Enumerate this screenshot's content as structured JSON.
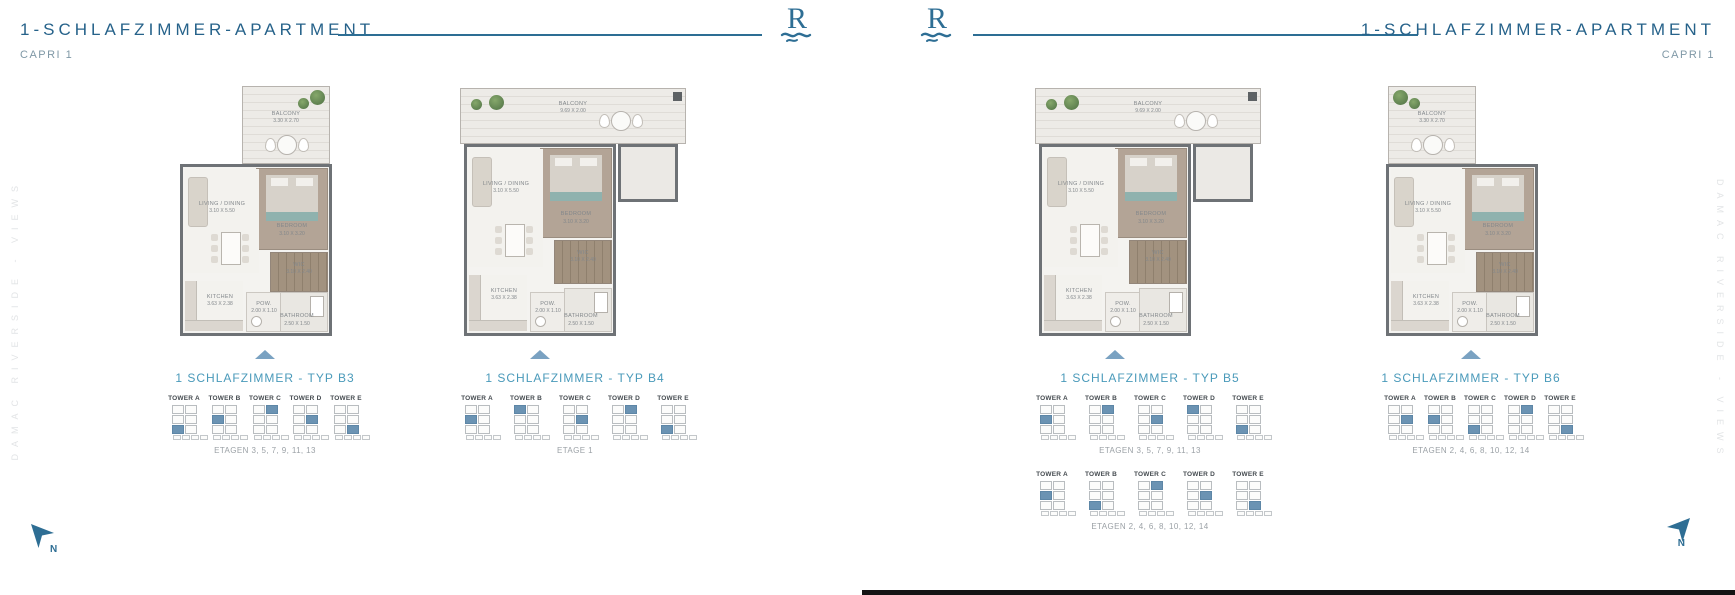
{
  "page": {
    "left": {
      "title": "1-SCHLAFZIMMER-APARTMENT",
      "subtitle": "CAPRI 1"
    },
    "right": {
      "title": "1-SCHLAFZIMMER-APARTMENT",
      "subtitle": "CAPRI 1"
    },
    "side_text": "DAMAC RIVERSIDE - VIEWS",
    "logo_letter": "R",
    "compass_label": "N"
  },
  "colors": {
    "title_blue": "#26628a",
    "accent_teal": "#4a9aba",
    "rule_blue": "#2d6e94",
    "tower_highlight": "#6b93b3",
    "caption_gray": "#9ba1a6"
  },
  "plans": [
    {
      "id": "b3",
      "label": "1 SCHLAFZIMMER - TYP B3",
      "variant": "small",
      "balcony_side": "right",
      "rooms": {
        "balcony": {
          "name": "BALCONY",
          "dims": "3.30 X 2.70"
        },
        "bedroom": {
          "name": "BEDROOM",
          "dims": "3.10 X 3.20"
        },
        "living": {
          "name": "LIVING / DINING",
          "dims": "3.10 X 5.50"
        },
        "wic": {
          "name": "WIC",
          "dims": "3.10 X 2.40"
        },
        "kitchen": {
          "name": "KITCHEN",
          "dims": "3.63 X 2.38"
        },
        "pow": {
          "name": "POW.",
          "dims": "2.00 X 1.10"
        },
        "bath": {
          "name": "BATHROOM",
          "dims": "2.50 X 1.50"
        }
      },
      "tower_rows": [
        {
          "towers": [
            "TOWER A",
            "TOWER B",
            "TOWER C",
            "TOWER D",
            "TOWER E"
          ],
          "highlights": [
            4,
            2,
            1,
            3,
            5
          ],
          "caption": "ETAGEN 3, 5, 7, 9, 11, 13"
        }
      ]
    },
    {
      "id": "b4",
      "label": "1 SCHLAFZIMMER - TYP B4",
      "variant": "large",
      "balcony_side": "right",
      "rooms": {
        "balcony": {
          "name": "BALCONY",
          "dims": "9.69 X 2.00"
        },
        "bedroom": {
          "name": "BEDROOM",
          "dims": "3.10 X 3.20"
        },
        "living": {
          "name": "LIVING / DINING",
          "dims": "3.10 X 5.50"
        },
        "wic": {
          "name": "WIC",
          "dims": "3.10 X 2.40"
        },
        "kitchen": {
          "name": "KITCHEN",
          "dims": "3.63 X 2.38"
        },
        "pow": {
          "name": "POW.",
          "dims": "2.00 X 1.10"
        },
        "bath": {
          "name": "BATHROOM",
          "dims": "2.50 X 1.50"
        }
      },
      "tower_rows": [
        {
          "towers": [
            "TOWER A",
            "TOWER B",
            "TOWER C",
            "TOWER D",
            "TOWER E"
          ],
          "highlights": [
            2,
            0,
            3,
            1,
            4
          ],
          "caption": "ETAGE 1"
        }
      ]
    },
    {
      "id": "b5",
      "label": "1 SCHLAFZIMMER - TYP B5",
      "variant": "large",
      "balcony_side": "right",
      "rooms": {
        "balcony": {
          "name": "BALCONY",
          "dims": "9.69 X 2.00"
        },
        "bedroom": {
          "name": "BEDROOM",
          "dims": "3.10 X 3.20"
        },
        "living": {
          "name": "LIVING / DINING",
          "dims": "3.10 X 5.50"
        },
        "wic": {
          "name": "WIC",
          "dims": "3.10 X 2.40"
        },
        "kitchen": {
          "name": "KITCHEN",
          "dims": "3.63 X 2.38"
        },
        "pow": {
          "name": "POW.",
          "dims": "2.00 X 1.10"
        },
        "bath": {
          "name": "BATHROOM",
          "dims": "2.50 X 1.50"
        }
      },
      "tower_rows": [
        {
          "towers": [
            "TOWER A",
            "TOWER B",
            "TOWER C",
            "TOWER D",
            "TOWER E"
          ],
          "highlights": [
            2,
            1,
            3,
            0,
            4
          ],
          "caption": "ETAGEN 3, 5, 7, 9, 11, 13"
        },
        {
          "towers": [
            "TOWER A",
            "TOWER B",
            "TOWER C",
            "TOWER D",
            "TOWER E"
          ],
          "highlights": [
            2,
            4,
            1,
            3,
            5
          ],
          "caption": "ETAGEN 2, 4, 6, 8, 10, 12, 14"
        }
      ]
    },
    {
      "id": "b6",
      "label": "1 SCHLAFZIMMER - TYP B6",
      "variant": "small",
      "balcony_side": "left",
      "rooms": {
        "balcony": {
          "name": "BALCONY",
          "dims": "3.30 X 2.70"
        },
        "bedroom": {
          "name": "BEDROOM",
          "dims": "3.10 X 3.20"
        },
        "living": {
          "name": "LIVING / DINING",
          "dims": "3.10 X 5.50"
        },
        "wic": {
          "name": "WIC",
          "dims": "3.10 X 2.40"
        },
        "kitchen": {
          "name": "KITCHEN",
          "dims": "3.63 X 2.38"
        },
        "pow": {
          "name": "POW.",
          "dims": "2.00 X 1.10"
        },
        "bath": {
          "name": "BATHROOM",
          "dims": "2.50 X 1.50"
        }
      },
      "tower_rows": [
        {
          "towers": [
            "TOWER A",
            "TOWER B",
            "TOWER C",
            "TOWER D",
            "TOWER E"
          ],
          "highlights": [
            3,
            2,
            4,
            1,
            5
          ],
          "caption": "ETAGEN 2, 4, 6, 8, 10, 12, 14"
        }
      ]
    }
  ]
}
